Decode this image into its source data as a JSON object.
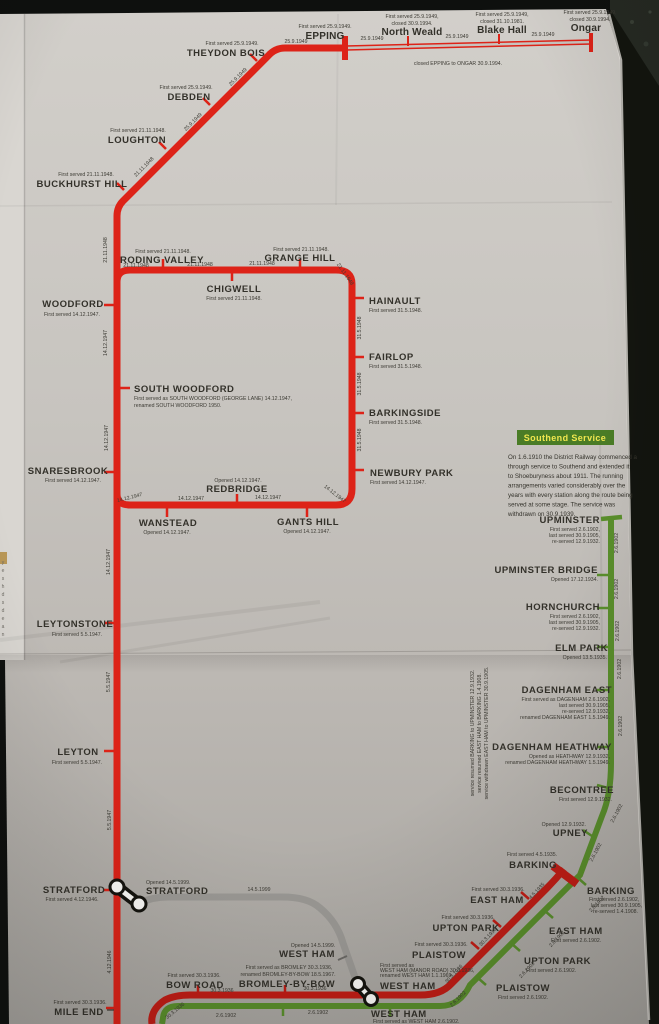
{
  "map": {
    "colors": {
      "central_red": "#dd2318",
      "metropolitan_red": "#c11d15",
      "district_green": "#5a8f2c",
      "jubilee_grey": "#9b9995",
      "paper": "#c7c4bf",
      "box_green": "#4a7c26",
      "box_title": "#f0e74f"
    },
    "dates": {
      "o1949": "25.9.1949",
      "n1948": "21.11.1948",
      "m1948": "31.5.1948",
      "d1947": "14.12.1947",
      "y1947": "5.5.1947",
      "s1946": "4.12.1946",
      "j1999": "14.5.1999",
      "dis1902": "2.6.1902",
      "met1936": "30.3.1936",
      "bark1935": "4.5.1935"
    },
    "closure_note": "closed EPPING to ONGAR 30.9.1994.",
    "edge_text": "yeshdsdean",
    "southend": {
      "title": "Southend Service",
      "lines": [
        "On 1.6.1910 the District Railway commenced a",
        "through service to Southend and extended it",
        "to Shoeburyness about 1911. The running",
        "arrangements varied considerably over the",
        "years with every station along the route being",
        "served at some stage. The service was",
        "withdrawn on 30.9.1939."
      ]
    },
    "service_note": [
      "service withdrawn EAST HAM to UPMINSTER 30.9.1905.",
      "service resumed EAST HAM to BARKING 1.4.1908.",
      "service resumed BARKING to UPMINSTER 12.9.1932."
    ],
    "stations": {
      "epping": {
        "n": "EPPING",
        "d1": "First served 25.9.1949."
      },
      "north_weald": {
        "n": "North Weald",
        "d1": "First served 25.9.1949,",
        "d2": "closed 30.9.1994."
      },
      "blake_hall": {
        "n": "Blake Hall",
        "d1": "First served 25.9.1949,",
        "d2": "closed 31.10.1981."
      },
      "ongar": {
        "n": "Ongar",
        "d1": "First served 25.9.1949,",
        "d2": "closed 30.9.1994."
      },
      "theydon_bois": {
        "n": "THEYDON BOIS",
        "d1": "First served 25.9.1949."
      },
      "debden": {
        "n": "DEBDEN",
        "d1": "First served 25.9.1949."
      },
      "loughton": {
        "n": "LOUGHTON",
        "d1": "First served 21.11.1948."
      },
      "buckhurst_hill": {
        "n": "BUCKHURST HILL",
        "d1": "First served 21.11.1948."
      },
      "roding_valley": {
        "n": "RODING VALLEY",
        "d1": "First served 21.11.1948."
      },
      "grange_hill": {
        "n": "GRANGE HILL",
        "d1": "First served 21.11.1948."
      },
      "chigwell": {
        "n": "CHIGWELL",
        "d1": "First served 21.11.1948."
      },
      "hainault": {
        "n": "HAINAULT",
        "d1": "First served 31.5.1948."
      },
      "fairlop": {
        "n": "FAIRLOP",
        "d1": "First served 31.5.1948."
      },
      "barkingside": {
        "n": "BARKINGSIDE",
        "d1": "First served 31.5.1948."
      },
      "newbury_park": {
        "n": "NEWBURY PARK",
        "d1": "First served 14.12.1947."
      },
      "woodford": {
        "n": "WOODFORD",
        "d1": "First served 14.12.1947."
      },
      "south_woodford": {
        "n": "SOUTH WOODFORD",
        "d1": "First served as SOUTH WOODFORD (GEORGE LANE) 14.12.1947,",
        "d2": "renamed SOUTH WOODFORD 1950."
      },
      "snaresbrook": {
        "n": "SNARESBROOK",
        "d1": "First served 14.12.1947."
      },
      "redbridge": {
        "n": "REDBRIDGE",
        "d1": "Opened 14.12.1947."
      },
      "wanstead": {
        "n": "WANSTEAD",
        "d1": "Opened 14.12.1947."
      },
      "gants_hill": {
        "n": "GANTS HILL",
        "d1": "Opened 14.12.1947."
      },
      "leytonstone": {
        "n": "LEYTONSTONE",
        "d1": "First served 5.5.1947."
      },
      "leyton": {
        "n": "LEYTON",
        "d1": "First served 5.5.1947."
      },
      "stratford_c": {
        "n": "STRATFORD",
        "d1": "First served 4.12.1946."
      },
      "stratford_j": {
        "n": "STRATFORD",
        "d1": "Opened 14.5.1999."
      },
      "mile_end": {
        "n": "MILE END",
        "d1": "First served 30.3.1936."
      },
      "bow_road": {
        "n": "BOW ROAD",
        "d1": "First served 30.3.1936."
      },
      "bromley": {
        "n": "BROMLEY-BY-BOW",
        "d1": "First served as BROMLEY 30.3.1936,",
        "d2": "renamed BROMLEY-BY-BOW 18.5.1967."
      },
      "west_ham_j": {
        "n": "WEST HAM",
        "d1": "Opened 14.5.1999."
      },
      "west_ham_m": {
        "n": "WEST HAM",
        "d1": "First served as",
        "d2": "WEST HAM (MANOR ROAD) 30.3.1936,",
        "d3": "renamed WEST HAM 1.1.1969."
      },
      "west_ham_d": {
        "n": "WEST HAM",
        "d1": "First served as WEST HAM 2.6.1902."
      },
      "plaistow_m": {
        "n": "PLAISTOW",
        "d1": "First served 30.3.1936."
      },
      "plaistow_d": {
        "n": "PLAISTOW",
        "d1": "First served 2.6.1902."
      },
      "upton_park_m": {
        "n": "UPTON PARK",
        "d1": "First served 30.3.1936."
      },
      "upton_park_d": {
        "n": "UPTON PARK",
        "d1": "First served 2.6.1902."
      },
      "east_ham_m": {
        "n": "EAST HAM",
        "d1": "First served 30.3.1936."
      },
      "east_ham_d": {
        "n": "EAST HAM",
        "d1": "First served 2.6.1902."
      },
      "barking_m": {
        "n": "BARKING",
        "d1": "First served 4.5.1935."
      },
      "barking_d": {
        "n": "BARKING",
        "d1": "First served 2.6.1902,",
        "d2": "last served 30.9.1905,",
        "d3": "re-served 1.4.1908."
      },
      "upney": {
        "n": "UPNEY",
        "d1": "Opened 12.9.1932."
      },
      "becontree": {
        "n": "BECONTREE",
        "d1": "First served 12.9.1932."
      },
      "dagenham_heathway": {
        "n": "DAGENHAM HEATHWAY",
        "d1": "Opened as HEATHWAY 12.9.1932,",
        "d2": "renamed DAGENHAM HEATHWAY 1.5.1949."
      },
      "dagenham_east": {
        "n": "DAGENHAM EAST",
        "d1": "First served as DAGENHAM 2.6.1902,",
        "d2": "last served 30.9.1905,",
        "d3": "re-served 12.9.1932,",
        "d4": "renamed DAGENHAM EAST 1.5.1949."
      },
      "elm_park": {
        "n": "ELM PARK",
        "d1": "Opened 13.5.1935."
      },
      "hornchurch": {
        "n": "HORNCHURCH",
        "d1": "First served 2.6.1902,",
        "d2": "last served 30.9.1905,",
        "d3": "re-served 12.9.1932."
      },
      "upminster_bridge": {
        "n": "UPMINSTER BRIDGE",
        "d1": "Opened 17.12.1934."
      },
      "upminster": {
        "n": "UPMINSTER",
        "d1": "First served 2.6.1902,",
        "d2": "last served 30.9.1905,",
        "d3": "re-served 12.9.1932."
      }
    }
  }
}
